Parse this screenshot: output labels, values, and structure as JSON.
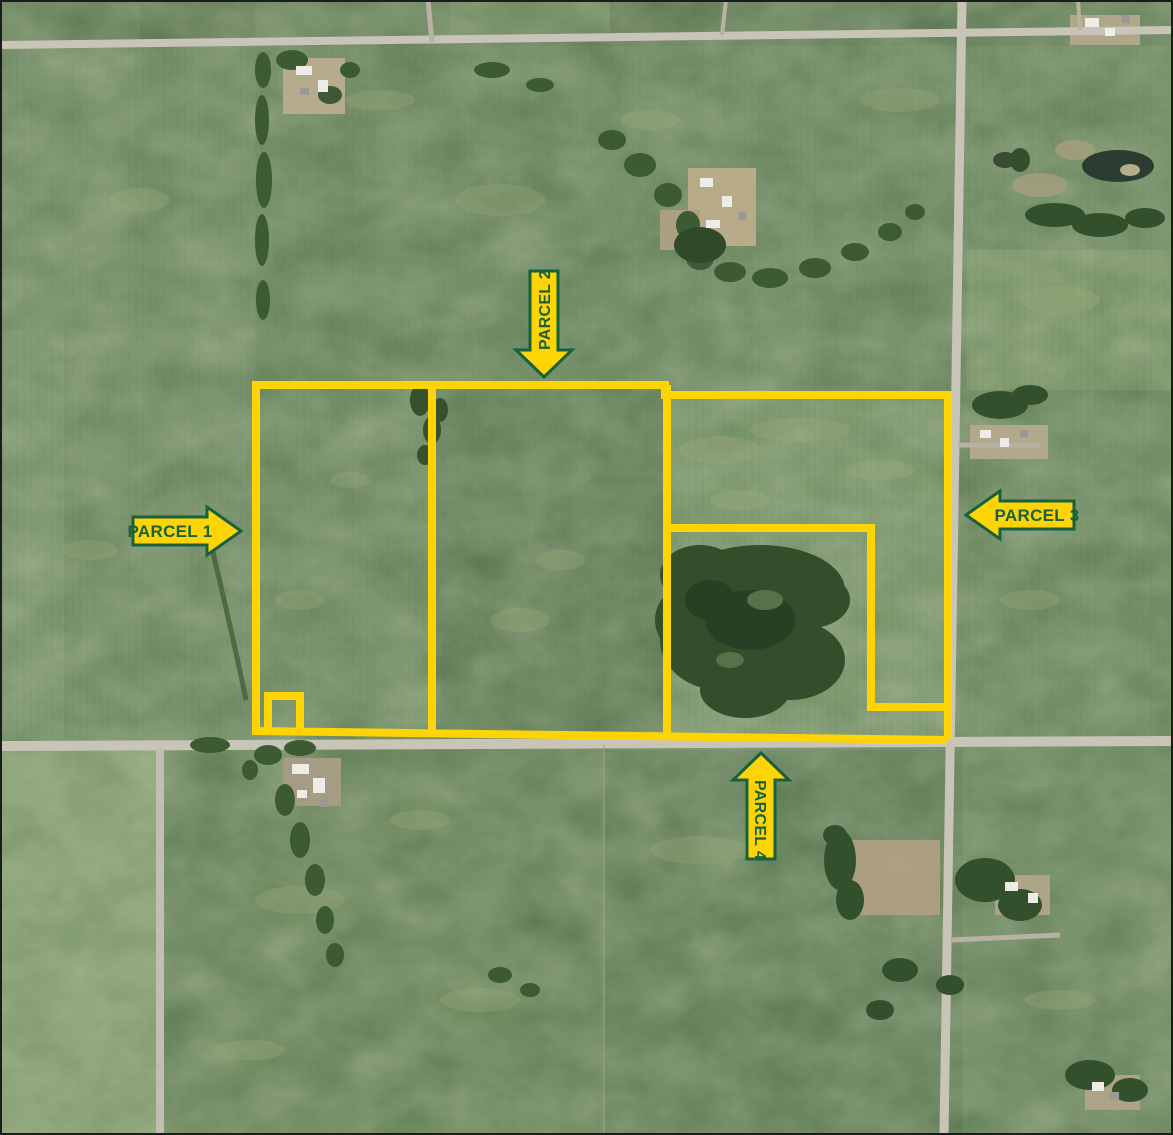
{
  "parcels": [
    {
      "id": "parcel-1",
      "label": "PARCEL 1",
      "arrow_direction": "right"
    },
    {
      "id": "parcel-2",
      "label": "PARCEL 2",
      "arrow_direction": "down"
    },
    {
      "id": "parcel-3",
      "label": "PARCEL 3",
      "arrow_direction": "left"
    },
    {
      "id": "parcel-4",
      "label": "PARCEL 4",
      "arrow_direction": "up"
    }
  ],
  "colors": {
    "parcel_boundary": "#FFD405",
    "label_fill": "#FFD405",
    "label_border": "#17613C",
    "label_text": "#17613C"
  }
}
